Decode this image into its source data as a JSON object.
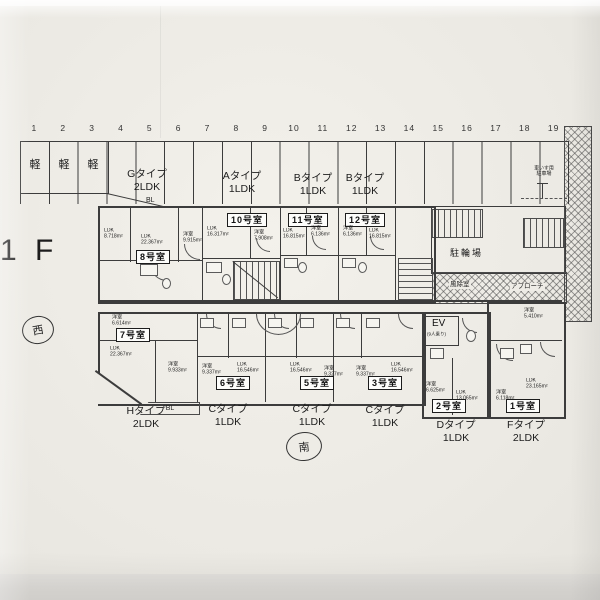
{
  "photo": {
    "paper_color": "#edebe5",
    "line_color": "#3c3c3c"
  },
  "floor_label": "1 F",
  "compass": {
    "west": "西",
    "south": "南"
  },
  "parking": {
    "stall_numbers": [
      "1",
      "2",
      "3",
      "4",
      "5",
      "6",
      "7",
      "8",
      "9",
      "10",
      "11",
      "12",
      "13",
      "14",
      "15",
      "16",
      "17",
      "18",
      "19"
    ],
    "kei_labels": [
      "軽",
      "軽",
      "軽"
    ],
    "wheelchair_note_line1": "車いす用",
    "wheelchair_note_line2": "駐車場",
    "bicycle_label": "駐輪場"
  },
  "type_labels_top": [
    {
      "line1": "Gタイプ",
      "line2": "2LDK"
    },
    {
      "line1": "Aタイプ",
      "line2": "1LDK"
    },
    {
      "line1": "Bタイプ",
      "line2": "1LDK"
    },
    {
      "line1": "Bタイプ",
      "line2": "1LDK"
    }
  ],
  "walkway": {
    "windbreak": "風除室",
    "approach": "アプローチ"
  },
  "elevator": {
    "label": "EV",
    "capacity": "(9人乗り)"
  },
  "balcony_labels": {
    "top": "BL",
    "bottom": "BL"
  },
  "units": {
    "u8": {
      "badge": "8号室",
      "r1_type": "LDK",
      "r1_area": "8.718m²",
      "r2_type": "LDK",
      "r2_area": "22.367m²",
      "r3_type": "洋室",
      "r3_area": "9.915m²"
    },
    "u10": {
      "badge": "10号室",
      "r1_type": "LDK",
      "r1_area": "16.317m²",
      "r2_type": "洋室",
      "r2_area": "7.908m²"
    },
    "u11": {
      "badge": "11号室",
      "r1_type": "LDK",
      "r1_area": "16.815m²",
      "r2_type": "洋室",
      "r2_area": "6.136m²"
    },
    "u12": {
      "badge": "12号室",
      "r1_type": "洋室",
      "r1_area": "6.136m²",
      "r2_type": "LDK",
      "r2_area": "16.815m²"
    },
    "u7": {
      "badge": "7号室",
      "r1_type": "洋室",
      "r1_area": "6.614m²",
      "r2_type": "LDK",
      "r2_area": "22.367m²",
      "r3_type": "洋室",
      "r3_area": "9.933m²",
      "type_line1": "Hタイプ",
      "type_line2": "2LDK"
    },
    "u6": {
      "badge": "6号室",
      "r1_type": "洋室",
      "r1_area": "9.337m²",
      "r2_type": "LDK",
      "r2_area": "16.546m²",
      "type_line1": "Cタイプ",
      "type_line2": "1LDK"
    },
    "u5": {
      "badge": "5号室",
      "r1_type": "LDK",
      "r1_area": "16.546m²",
      "r2_type": "洋室",
      "r2_area": "9.327m²",
      "type_line1": "Cタイプ",
      "type_line2": "1LDK"
    },
    "u3": {
      "badge": "3号室",
      "r1_type": "洋室",
      "r1_area": "9.337m²",
      "r2_type": "LDK",
      "r2_area": "16.546m²",
      "type_line1": "Cタイプ",
      "type_line2": "1LDK"
    },
    "u2": {
      "badge": "2号室",
      "r1_type": "洋室",
      "r1_area": "6.625m²",
      "r2_type": "LDK",
      "r2_area": "13.065m²",
      "type_line1": "Dタイプ",
      "type_line2": "1LDK"
    },
    "u1": {
      "badge": "1号室",
      "r1_type": "洋室",
      "r1_area": "5.410m²",
      "r2_type": "洋室",
      "r2_area": "6.118m²",
      "r3_type": "LDK",
      "r3_area": "23.165m²",
      "type_line1": "Fタイプ",
      "type_line2": "2LDK"
    }
  }
}
